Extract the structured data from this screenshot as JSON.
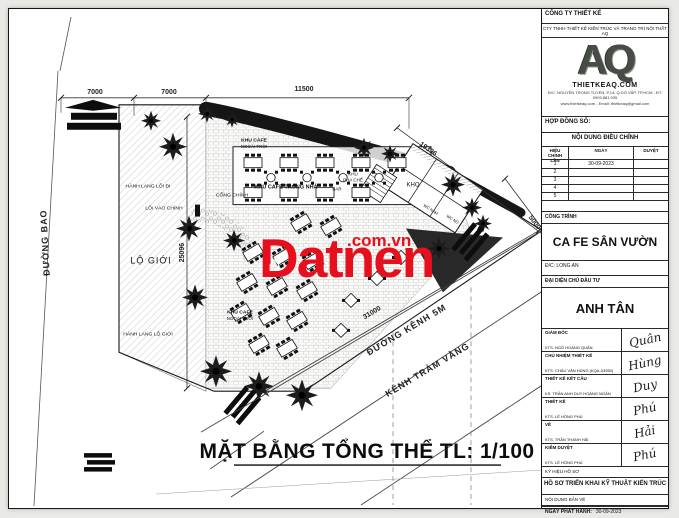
{
  "watermark": {
    "brand": "Datnen",
    "suffix": ".com.vn",
    "house_icon": "⌂",
    "color": "#e60f1e"
  },
  "plan": {
    "sheet_title": "MẶT BẰNG TỔNG THỂ TL: 1/100",
    "dim_road_width": "7000",
    "dim_corridor": "7000",
    "dim_top": "11500",
    "dim_ne_edge": "19396",
    "dim_e_edge": "5000",
    "dim_left": "25096",
    "dim_bottom": "31000",
    "road_left": "ĐƯỜNG BAO",
    "road_canal": "ĐƯỜNG KÊNH 5M",
    "canal_name": "KÊNH TRÀM VÀNG",
    "labels": {
      "corridor": "HÀNH LANG LỐI ĐI",
      "setback": "LỘ GIỚI",
      "corridor_setback": "HÀNH LANG LỘ GIỚI",
      "outdoor_cafe_line1": "KHU CAFE",
      "outdoor_cafe_line2": "NGOÀI TRỜI",
      "indoor_cafe": "KHU CAFE TRONG NHÀ",
      "bar_counter_line1": "KHU",
      "bar_counter_line2": "PHA CHẾ",
      "bar": "BAR",
      "storage": "KHO",
      "wc_men": "WC NAM",
      "wc_women": "WC NỮ",
      "main_gate": "CỔNG CHÍNH",
      "main_entrance": "LỐI VÀO CHÍNH"
    }
  },
  "title_block": {
    "company_header": "CÔNG TY THIẾT KẾ",
    "company_sub": "CTY TNHH THIẾT KẾ KIẾN TRÚC VÀ TRANG TRÍ NỘI THẤT AQ",
    "logo_text": "AQ",
    "logo_site": "THIETKEAQ.COM",
    "logo_addr1": "Đ/C: NGUYỄN TRỌNG TUYỂN, P.14, Q.GÒ VẤP, TP.HCM - ĐT: 0909 881 935",
    "logo_addr2": "www.thietkeaq.com - Email: thietkeaq@gmail.com",
    "contract_label": "HỢP ĐỒNG SỐ:",
    "revisions": {
      "header": "NỘI DUNG ĐIỀU CHỈNH",
      "col_rev": "HIỆU CHỈNH LẦN",
      "col_date": "NGÀY",
      "col_approve": "DUYỆT",
      "rows": [
        {
          "no": "1",
          "date": "30-09-2023",
          "approve": ""
        },
        {
          "no": "2",
          "date": "",
          "approve": ""
        },
        {
          "no": "3",
          "date": "",
          "approve": ""
        },
        {
          "no": "4",
          "date": "",
          "approve": ""
        },
        {
          "no": "5",
          "date": "",
          "approve": ""
        }
      ]
    },
    "project_label": "CÔNG TRÌNH",
    "project_name": "CA FE SÂN VƯỜN",
    "project_address": "Đ/C:  LONG AN",
    "owner_label": "ĐẠI DIỆN CHỦ ĐẦU TƯ",
    "owner_name": "ANH TÂN",
    "signers": [
      {
        "role": "GIÁM ĐỐC",
        "name": "KTS. NGÔ HOÀNG QUÂN",
        "signature": "Quân"
      },
      {
        "role": "CHỦ NHIỆM THIẾT KẾ",
        "name": "KTS. CHÂU VĂN HÙNG (KQA-03950)",
        "signature": "Hùng"
      },
      {
        "role": "THIẾT KẾ KẾT CẤU",
        "name": "KS. TRẦN ANH DUY HOÀNG NGÂN",
        "signature": "Duy"
      },
      {
        "role": "THIẾT KẾ",
        "name": "KTS. LÊ HỒNG PHÚ",
        "signature": "Phú"
      },
      {
        "role": "VẼ",
        "name": "KTS. TRẦN THANH HẢI",
        "signature": "Hải"
      },
      {
        "role": "KIỂM DUYỆT",
        "name": "KTS. LÊ HỒNG PHÚ",
        "signature": "Phú"
      }
    ],
    "dossier_label": "KÝ HIỆU HỒ SƠ",
    "dossier_name": "HỒ SƠ TRIỂN KHAI KỸ THUẬT KIẾN TRÚC",
    "sheet_content_label": "NỘI DUNG BẢN VẼ",
    "issue_date_label": "NGÀY PHÁT HÀNH:",
    "issue_date": "30-09-2023",
    "paper_label": "ĐỊNH DẠNG KHỔ GIẤY: A3",
    "code_label": "KÝ HIỆU BẢN VẼ: KT",
    "page_label": "SỐ TRANG:",
    "total_pages": "TỔNG SỐ TRANG: 32"
  }
}
